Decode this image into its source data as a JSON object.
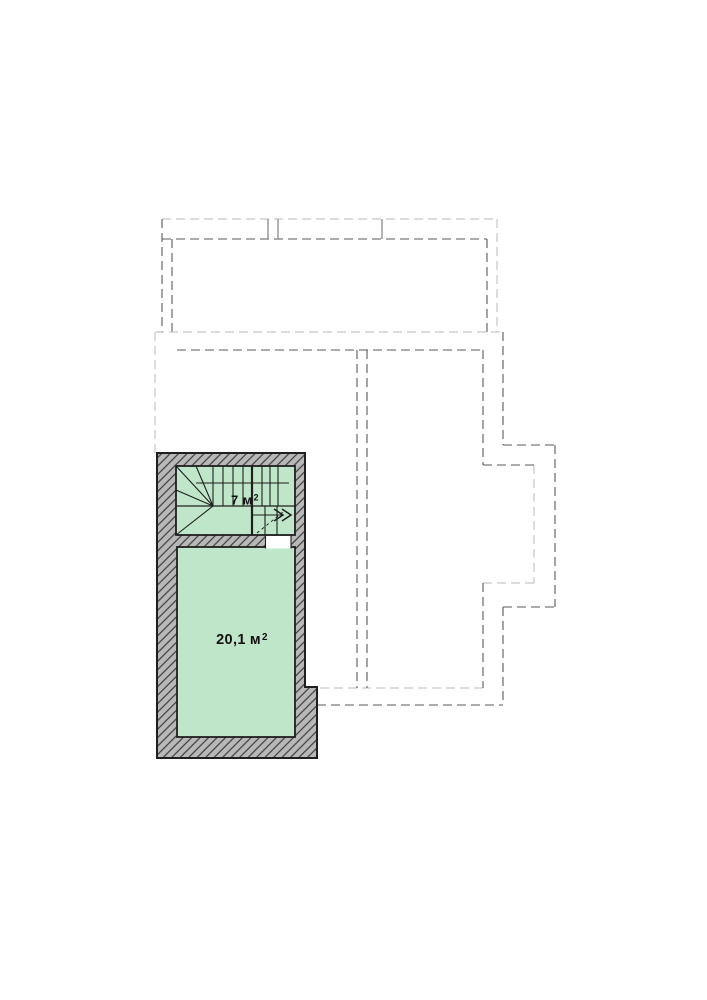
{
  "plan": {
    "background": "#ffffff",
    "colors": {
      "room_fill": "#c0e6ca",
      "wall_fill": "#b8b8b8",
      "wall_hatch": "#3c3c3c",
      "outline": "#1f1f1f",
      "dash_dark": "#5a5a5a",
      "dash_light": "#c6c6c6",
      "pillar": "#8a8a8a",
      "label_color": "#111111"
    },
    "rooms": [
      {
        "id": "staircase",
        "area_value": "7",
        "area_unit": "м",
        "area_exponent": "2"
      },
      {
        "id": "main-room",
        "area_value": "20,1",
        "area_unit": "м",
        "area_exponent": "2"
      }
    ]
  }
}
